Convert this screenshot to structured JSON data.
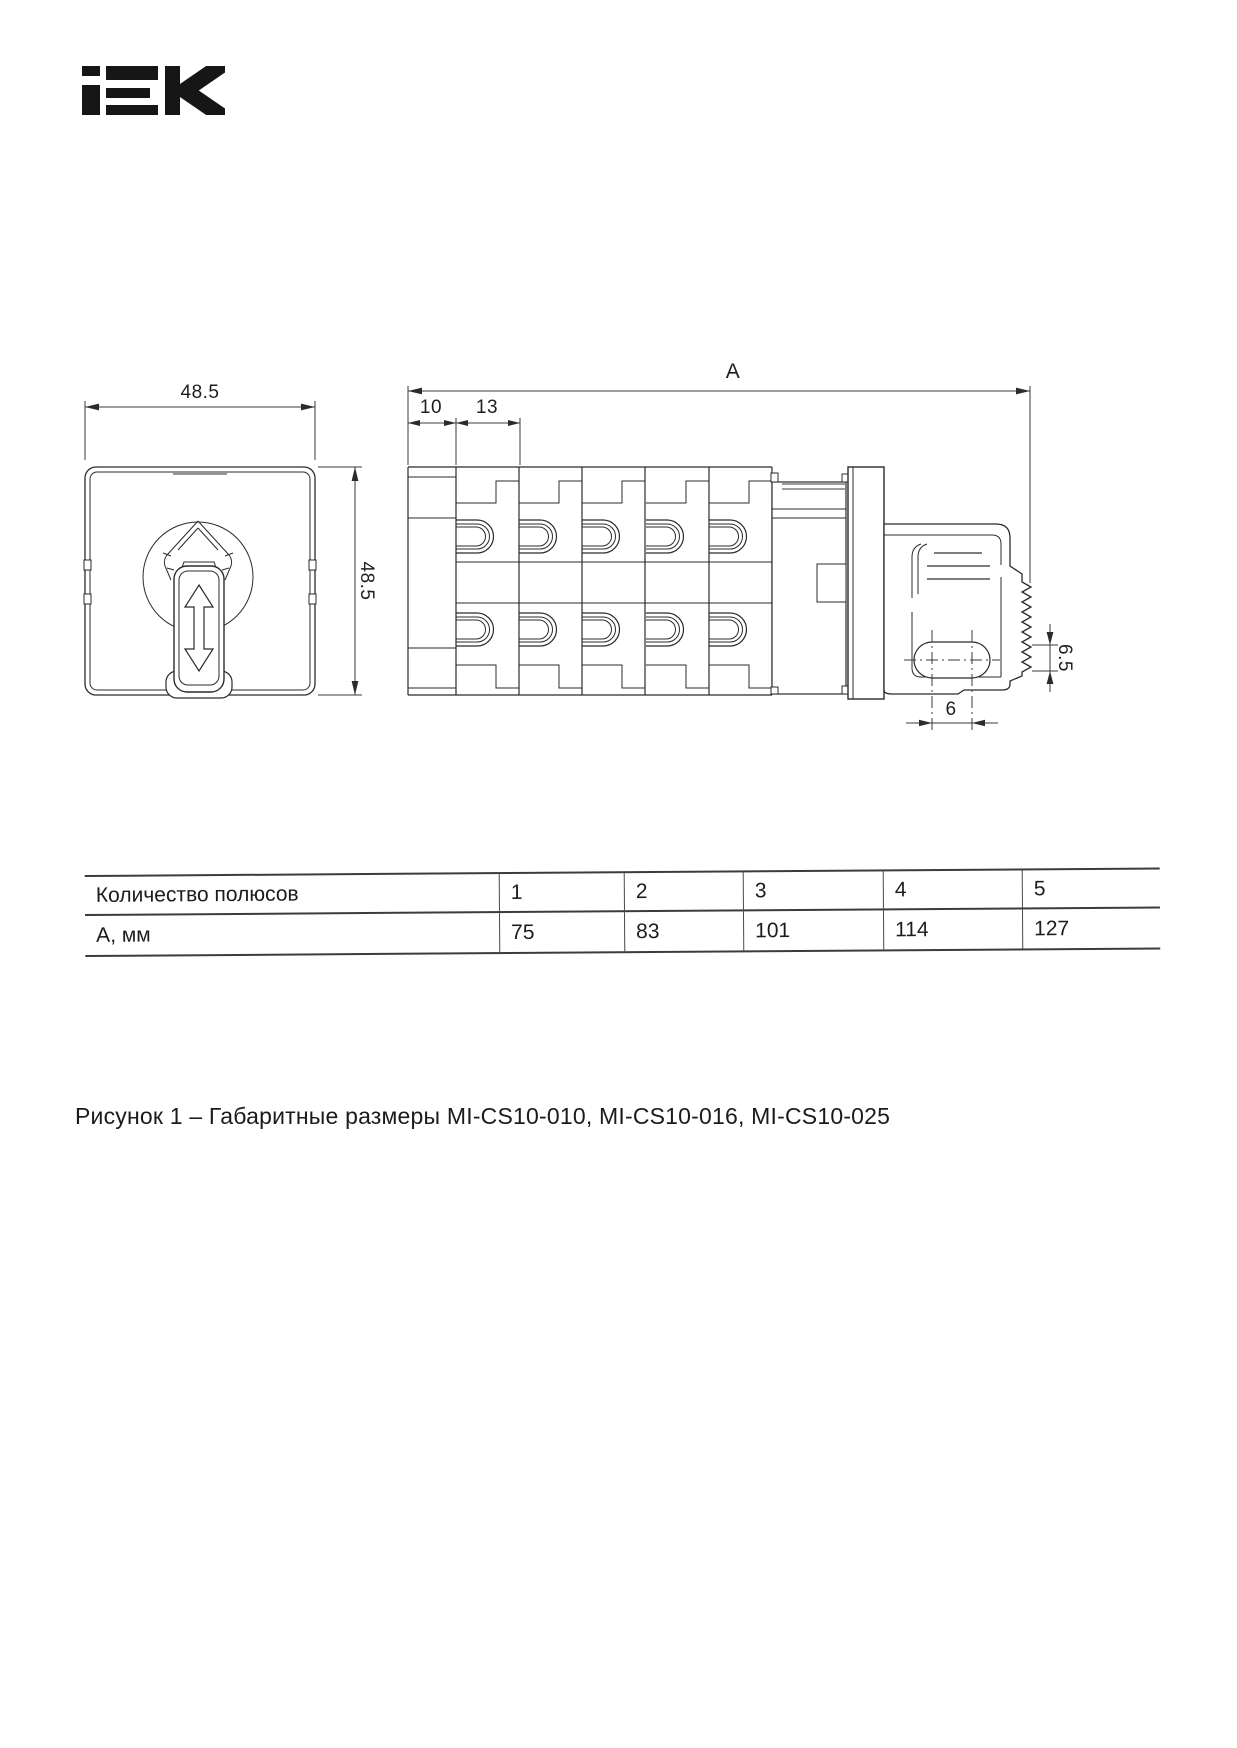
{
  "brand": "IEK",
  "figure": {
    "front_view": {
      "dim_width": "48.5",
      "dim_height": "48.5"
    },
    "side_view": {
      "dim_total": "A",
      "dim_back": "10",
      "dim_module": "13",
      "dim_slot_height": "6.5",
      "dim_slot_pitch": "6"
    }
  },
  "table": {
    "rows": [
      {
        "label": "Количество полюсов",
        "values": [
          "1",
          "2",
          "3",
          "4",
          "5"
        ]
      },
      {
        "label": "А, мм",
        "values": [
          "75",
          "83",
          "101",
          "114",
          "127"
        ]
      }
    ]
  },
  "caption": "Рисунок 1 – Габаритные размеры MI-CS10-010, MI-CS10-016, MI-CS10-025",
  "colors": {
    "ink": "#1f1f1f",
    "line": "#2b2b2b",
    "dim_line": "#3a3a3a",
    "screw_gray": "#7d7d7d"
  }
}
